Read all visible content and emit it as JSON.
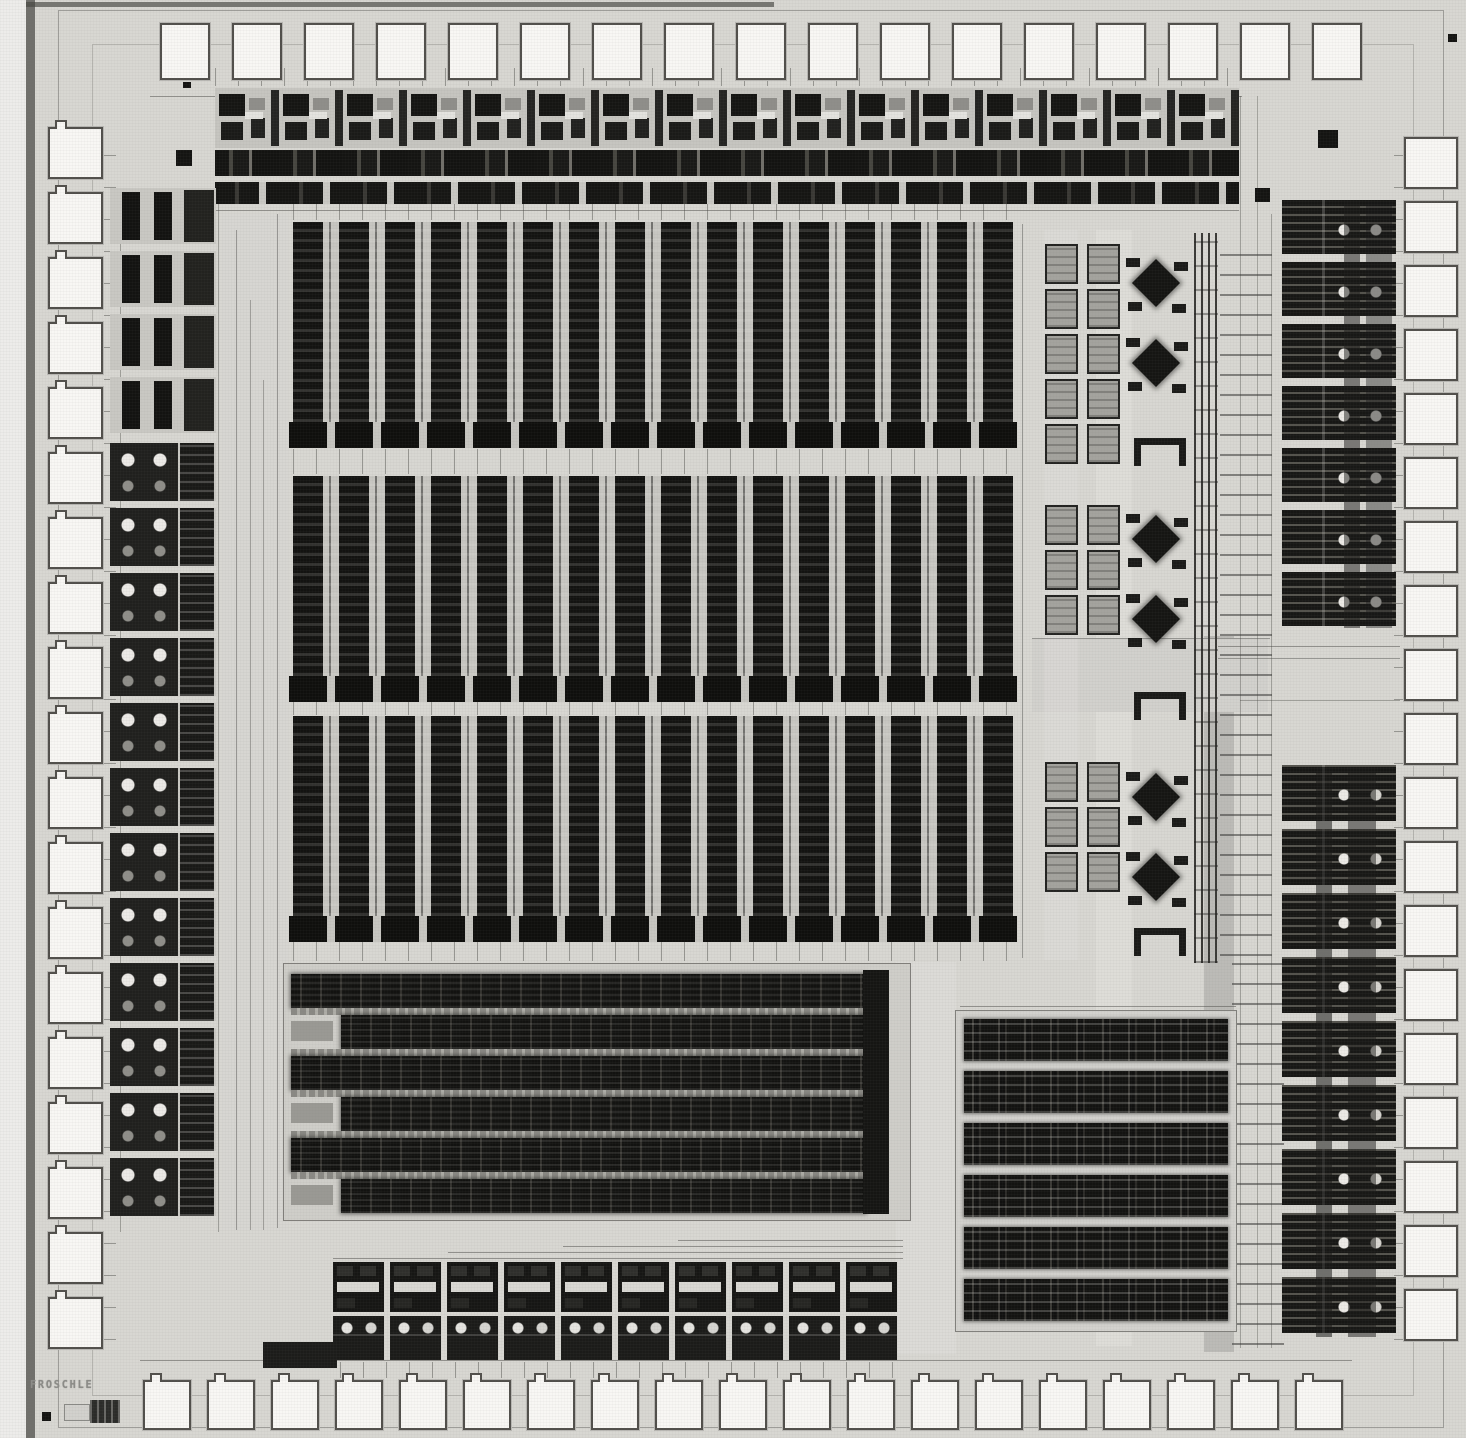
{
  "meta": {
    "die_label": "FROSCHLE"
  },
  "colors": {
    "background": "#d8d7d2",
    "pad_fill": "#f8f7f4",
    "pad_border": "#514f4b",
    "block_dark": "#151513",
    "block_gray": "#a4a39e",
    "label_gray": "#8c8c88"
  },
  "layout": {
    "stage": {
      "w": 1466,
      "h": 1438
    },
    "pads": {
      "top": {
        "x": 160,
        "y": 23,
        "w": 50,
        "h": 57,
        "pitch": 72,
        "count": 17,
        "axis": "x",
        "notch": false
      },
      "bottom": {
        "x": 143,
        "y": 1380,
        "w": 48,
        "h": 50,
        "pitch": 64,
        "count": 19,
        "axis": "x",
        "notch": true
      },
      "left": {
        "x": 48,
        "y": 127,
        "w": 55,
        "h": 52,
        "pitch": 65,
        "count": 19,
        "axis": "y",
        "notch": true
      },
      "right": {
        "x": 1404,
        "y": 137,
        "w": 54,
        "h": 52,
        "pitch": 64,
        "count": 19,
        "axis": "y",
        "notch": false
      }
    },
    "top_strip": {
      "x": 215,
      "y": 88,
      "w": 1024,
      "cell_w": 64,
      "cells": 16,
      "rowA_h": 60,
      "rowB_y": 62,
      "rowB_h": 26,
      "rowC_y": 94,
      "rowC_h": 22
    },
    "band": {
      "x": 293,
      "w": 720,
      "col_h": 200,
      "feet_h": 26
    },
    "bands": [
      {
        "y": 222
      },
      {
        "y": 476
      },
      {
        "y": 716
      }
    ],
    "right_mid": {
      "gray": {
        "x": 1045,
        "cols": [
          0,
          42
        ],
        "w": 33,
        "h": 40,
        "pitch_y": 45,
        "groups": [
          {
            "y": 244,
            "rows": 5
          },
          {
            "y": 505,
            "rows": 3
          },
          {
            "y": 762,
            "rows": 3
          }
        ]
      },
      "analog": {
        "x": 1124,
        "w": 66,
        "h": 74,
        "ys": [
          250,
          330,
          506,
          586,
          764,
          844
        ]
      },
      "stools": {
        "x": 1134,
        "w": 52,
        "h": 28,
        "ys": [
          438,
          692,
          928
        ]
      },
      "bus": {
        "x": 1194,
        "y": 233,
        "w": 24,
        "h": 730
      }
    },
    "right_cols": {
      "x": 1282,
      "w": 114,
      "upper": {
        "y": 200,
        "count": 7,
        "pitch": 62,
        "h": 54
      },
      "lower": {
        "y": 765,
        "count": 9,
        "pitch": 64,
        "h": 56
      }
    },
    "left_col": {
      "x": 110,
      "w": 106,
      "bars": {
        "y": 188,
        "count": 4,
        "pitch": 63,
        "h": 56
      },
      "dots": {
        "y": 443,
        "count": 12,
        "pitch": 65,
        "h": 58
      }
    },
    "mid_block": {
      "x": 283,
      "y": 963,
      "w": 628,
      "h": 258,
      "rows": 6,
      "row_h": 34,
      "row_pitch": 41,
      "bar_x": 579,
      "bar_w": 26
    },
    "br_array": {
      "x": 955,
      "y": 1010,
      "w": 282,
      "h": 322,
      "rows": 6,
      "row_h": 42,
      "row_pitch": 52
    },
    "bottom_strip": {
      "x": 333,
      "y": 1238,
      "cells": 10,
      "cell_w": 57
    },
    "marks": [
      [
        176,
        150,
        16,
        16
      ],
      [
        1318,
        130,
        20,
        18
      ],
      [
        1255,
        188,
        15,
        14
      ],
      [
        183,
        82,
        8,
        6
      ],
      [
        1448,
        34,
        9,
        8
      ],
      [
        42,
        1412,
        9,
        9
      ]
    ],
    "wires": [
      [
        150,
        96,
        1092,
        1,
        0.5
      ],
      [
        215,
        210,
        1024,
        1,
        0.5
      ],
      [
        236,
        230,
        1,
        1000,
        0.45
      ],
      [
        250,
        300,
        1,
        930,
        0.4
      ],
      [
        263,
        380,
        1,
        850,
        0.4
      ],
      [
        277,
        214,
        1,
        1014,
        0.45
      ],
      [
        1240,
        96,
        1,
        1252,
        0.4
      ],
      [
        1257,
        96,
        1,
        1252,
        0.35
      ],
      [
        1271,
        214,
        1,
        1134,
        0.4
      ],
      [
        1218,
        646,
        182,
        1,
        0.5
      ],
      [
        1218,
        658,
        182,
        1,
        0.45
      ],
      [
        1032,
        638,
        238,
        1,
        0.45
      ],
      [
        960,
        1006,
        276,
        1,
        0.5
      ],
      [
        140,
        1360,
        1212,
        1,
        0.5
      ],
      [
        120,
        190,
        1,
        1042,
        0.4
      ],
      [
        218,
        190,
        1,
        1042,
        0.4
      ],
      [
        1022,
        224,
        1,
        734,
        0.45
      ],
      [
        1240,
        700,
        160,
        1,
        0.4
      ],
      [
        905,
        963,
        1,
        258,
        0.45
      ],
      [
        955,
        1120,
        280,
        1,
        0.35
      ]
    ],
    "tints": [
      [
        896,
        962,
        60,
        392,
        "#dcdbd7"
      ],
      [
        1204,
        636,
        30,
        716,
        "#bcbbb7"
      ],
      [
        1096,
        230,
        36,
        1116,
        "rgba(230,229,225,0.45)"
      ],
      [
        1032,
        638,
        236,
        74,
        "#d2d1cd"
      ],
      [
        1044,
        230,
        34,
        730,
        "rgba(224,223,219,0.4)"
      ],
      [
        222,
        214,
        66,
        1016,
        "rgba(214,213,209,0.5)"
      ]
    ],
    "vchannels": [
      [
        293,
        204,
        722,
        16
      ],
      [
        293,
        449,
        722,
        25
      ],
      [
        293,
        702,
        722,
        13
      ],
      [
        293,
        942,
        722,
        19
      ],
      [
        215,
        68,
        1024,
        18
      ],
      [
        340,
        1362,
        560,
        16
      ]
    ],
    "hchannels": [
      [
        104,
        140,
        12,
        1200
      ],
      [
        1394,
        150,
        12,
        1190
      ]
    ],
    "io_bars": [
      [
        1344,
        202,
        16,
        426,
        0.5
      ],
      [
        1366,
        202,
        26,
        426,
        0.4
      ],
      [
        1316,
        767,
        16,
        570,
        0.55
      ],
      [
        1348,
        767,
        28,
        570,
        0.5
      ]
    ]
  }
}
